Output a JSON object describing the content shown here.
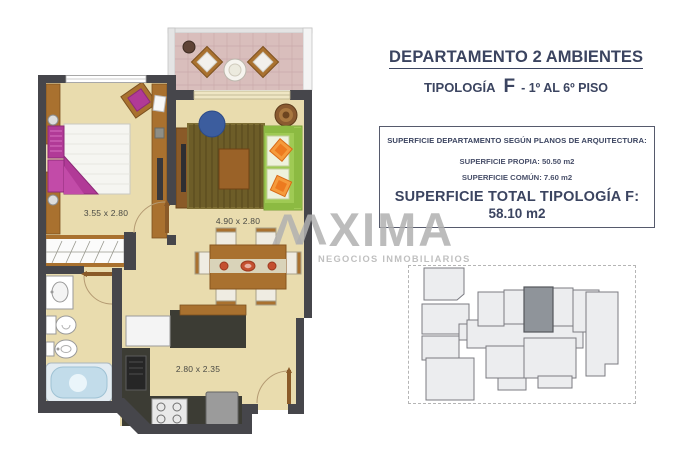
{
  "header": {
    "title_main": "DEPARTAMENTO",
    "title_bold": "2 AMBIENTES",
    "subtitle_label": "TIPOLOGÍA",
    "subtitle_type": "F",
    "subtitle_floors": "- 1º AL 6º PISO"
  },
  "surface_box": {
    "heading": "SUPERFICIE DEPARTAMENTO SEGÚN PLANOS DE ARQUITECTURA:",
    "own_surface": "SUPERFICIE PROPIA: 50.50 m2",
    "common_surface": "SUPERFICIE COMÚN: 7.60 m2",
    "total_label": "SUPERFICIE TOTAL TIPOLOGÍA F:",
    "total_value": "58.10 m2"
  },
  "floorplan": {
    "bedroom_dimensions": "3.55 x 2.80",
    "living_dimensions": "4.90 x 2.80",
    "kitchen_dimensions": "2.80 x 2.35"
  },
  "watermark": {
    "logo": "ΛΛ",
    "name": "XIMA",
    "tagline": "NEGOCIOS INMOBILIARIOS"
  },
  "keyplan": {
    "highlighted_unit": "F"
  },
  "colors": {
    "accent_navy": "#3b4460",
    "wall": "#46464b",
    "floor": "#e9dcae",
    "balcony_floor": "#d9bebc",
    "rug_brown": "#6d5d28",
    "sofa_green": "#9fca54",
    "bed_magenta": "#b13a97",
    "wood": "#a9712f",
    "bathtub_blue": "#c2dcea",
    "highlight_unit": "#8f949a",
    "watermark_gray": "#c3c3c3"
  }
}
